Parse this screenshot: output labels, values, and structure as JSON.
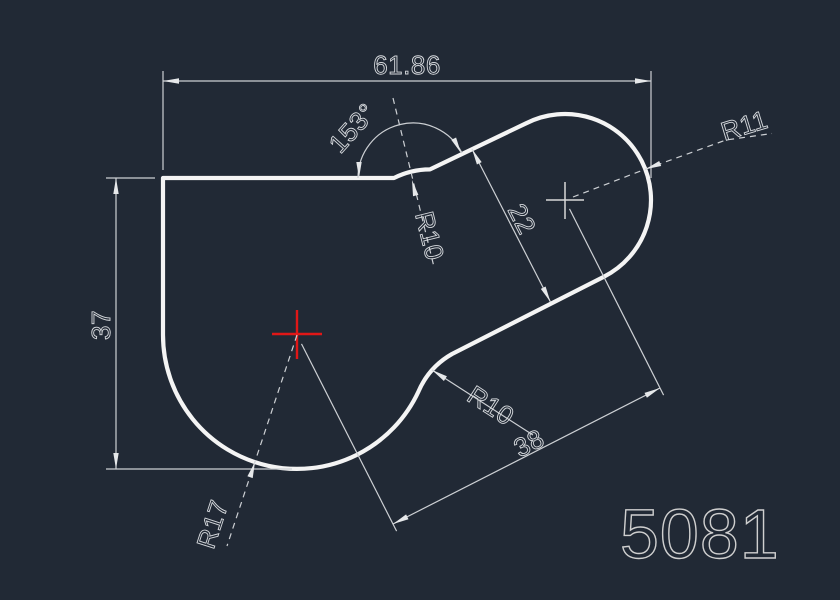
{
  "drawing": {
    "part_number": "5081",
    "dimensions": {
      "width": "61.86",
      "height": "37",
      "angle": "153°",
      "neck_width": "22",
      "center_distance": "38",
      "fillet_top": "R10",
      "fillet_bottom": "R10",
      "lobe_right": "R11",
      "lobe_left": "R17"
    },
    "colors": {
      "background": "#212935",
      "geometry": "#f4f4f4",
      "dimension_lines": "#cdd0d4",
      "center_mark_red": "#e01717",
      "center_mark_white": "#d8d8d8"
    }
  }
}
